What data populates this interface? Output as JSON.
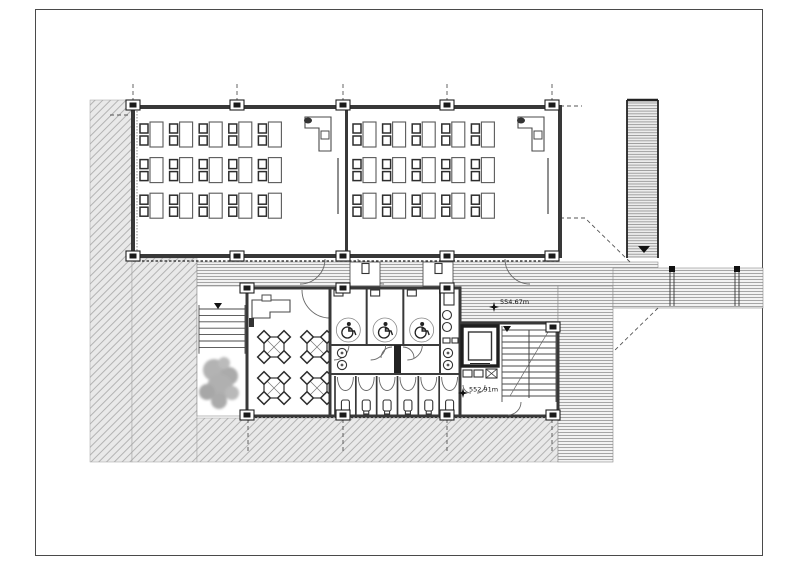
{
  "drawing": {
    "title": "Architectural floor plan — classroom wing with WC block, stair core, exterior deck and ramp",
    "labels": {
      "deck_elevation": "554.67m",
      "stair_lobby_elevation": "552.91m"
    },
    "rooms": {
      "classroom_1": {
        "desk_rows": 3,
        "desk_cols": 5,
        "chairs_per_desk": 2,
        "teacher_desks": 1
      },
      "classroom_2": {
        "desk_rows": 3,
        "desk_cols": 5,
        "chairs_per_desk": 2,
        "teacher_desks": 1
      },
      "common_room": {
        "tables": 4,
        "chairs_per_table": 4,
        "work_desks": 1
      },
      "wc_block": {
        "accessible_stalls": 3,
        "toilet_stalls": 6,
        "wash_basins": 4
      },
      "stair_core": {
        "elevators": 1
      }
    },
    "site": {
      "deck_posts": 2,
      "trees": 1,
      "ramps": 1,
      "exterior_stairs": 1
    }
  },
  "colors": {
    "paper": "#ffffff",
    "line": "#2f2f2f",
    "hatch_line": "#b3b3b3",
    "hatch_bg": "#e9e9e9",
    "deck_line": "#9c9c9c",
    "deck_bg": "#f2f2f2",
    "tree": "#8f8f8f"
  }
}
